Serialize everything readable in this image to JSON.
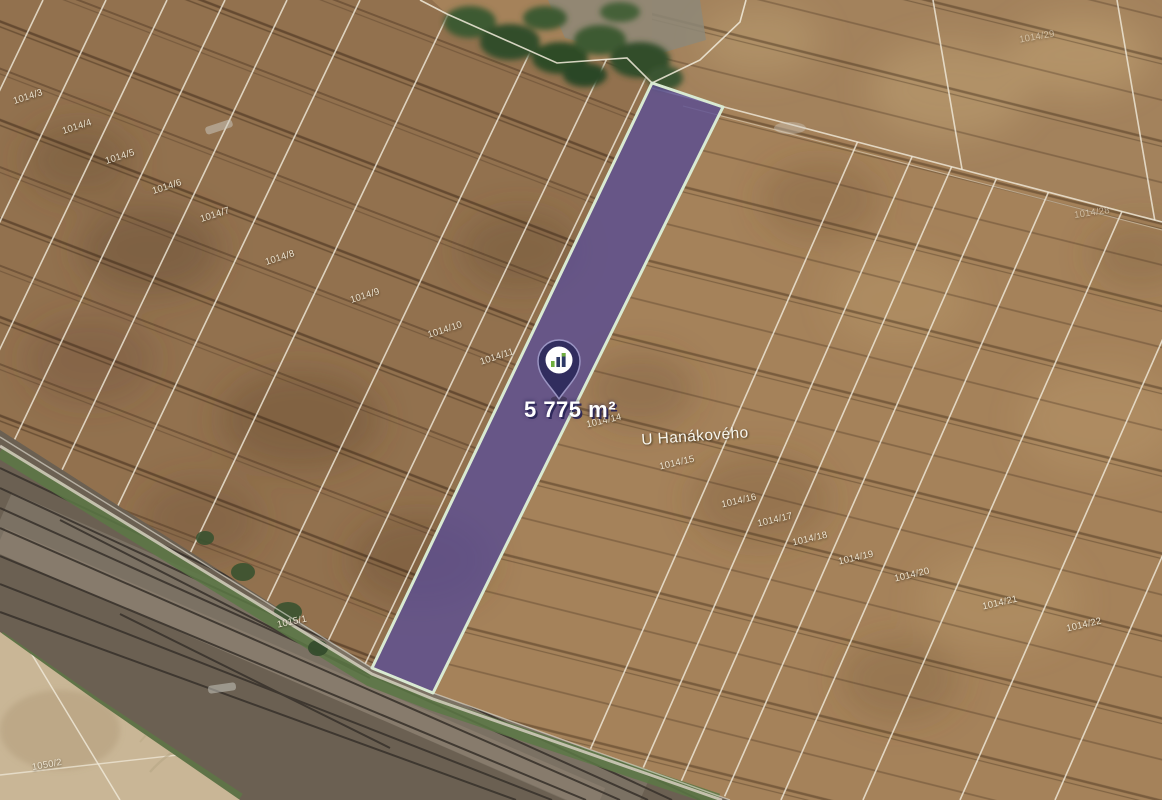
{
  "map": {
    "type": "satellite-cadastral-map",
    "highlight": {
      "area_label": "5 775 m²",
      "parcel_number": "1014/14",
      "pin_icon": "location-pin",
      "pin_logo_icon": "bar-chart-logo"
    },
    "street_label": "U Hanákového",
    "colors": {
      "highlight-fill": "#564a94",
      "highlight-stroke": "#d9ead2",
      "pin-body": "#312d5e",
      "pin-rim": "#9a94c2",
      "logo-green": "#6fae3f",
      "logo-navy": "#2e3a66",
      "line-ivory": "#f2ecdc"
    },
    "parcel_labels": [
      {
        "text": "1014/3",
        "x": 28,
        "y": 97,
        "rot": -18
      },
      {
        "text": "1014/4",
        "x": 77,
        "y": 127,
        "rot": -18
      },
      {
        "text": "1014/5",
        "x": 120,
        "y": 157,
        "rot": -18
      },
      {
        "text": "1014/6",
        "x": 167,
        "y": 187,
        "rot": -18
      },
      {
        "text": "1014/7",
        "x": 215,
        "y": 215,
        "rot": -18
      },
      {
        "text": "1014/8",
        "x": 280,
        "y": 258,
        "rot": -18
      },
      {
        "text": "1014/9",
        "x": 365,
        "y": 296,
        "rot": -18
      },
      {
        "text": "1014/10",
        "x": 445,
        "y": 330,
        "rot": -18
      },
      {
        "text": "1014/11",
        "x": 497,
        "y": 357,
        "rot": -18
      },
      {
        "text": "1014/14",
        "x": 604,
        "y": 421,
        "rot": -13
      },
      {
        "text": "1014/15",
        "x": 677,
        "y": 463,
        "rot": -13
      },
      {
        "text": "1014/16",
        "x": 739,
        "y": 501,
        "rot": -13
      },
      {
        "text": "1014/17",
        "x": 775,
        "y": 520,
        "rot": -13
      },
      {
        "text": "1014/18",
        "x": 810,
        "y": 539,
        "rot": -13
      },
      {
        "text": "1014/19",
        "x": 856,
        "y": 558,
        "rot": -13
      },
      {
        "text": "1014/20",
        "x": 912,
        "y": 575,
        "rot": -13
      },
      {
        "text": "1014/21",
        "x": 1000,
        "y": 603,
        "rot": -13
      },
      {
        "text": "1014/22",
        "x": 1084,
        "y": 625,
        "rot": -13
      },
      {
        "text": "1014/29",
        "x": 1037,
        "y": 37,
        "rot": -10,
        "faint": true
      },
      {
        "text": "1014/28",
        "x": 1092,
        "y": 213,
        "rot": -8,
        "faint": true
      },
      {
        "text": "1015/1",
        "x": 292,
        "y": 622,
        "rot": -12
      },
      {
        "text": "1050/2",
        "x": 47,
        "y": 765,
        "rot": -10
      }
    ]
  }
}
